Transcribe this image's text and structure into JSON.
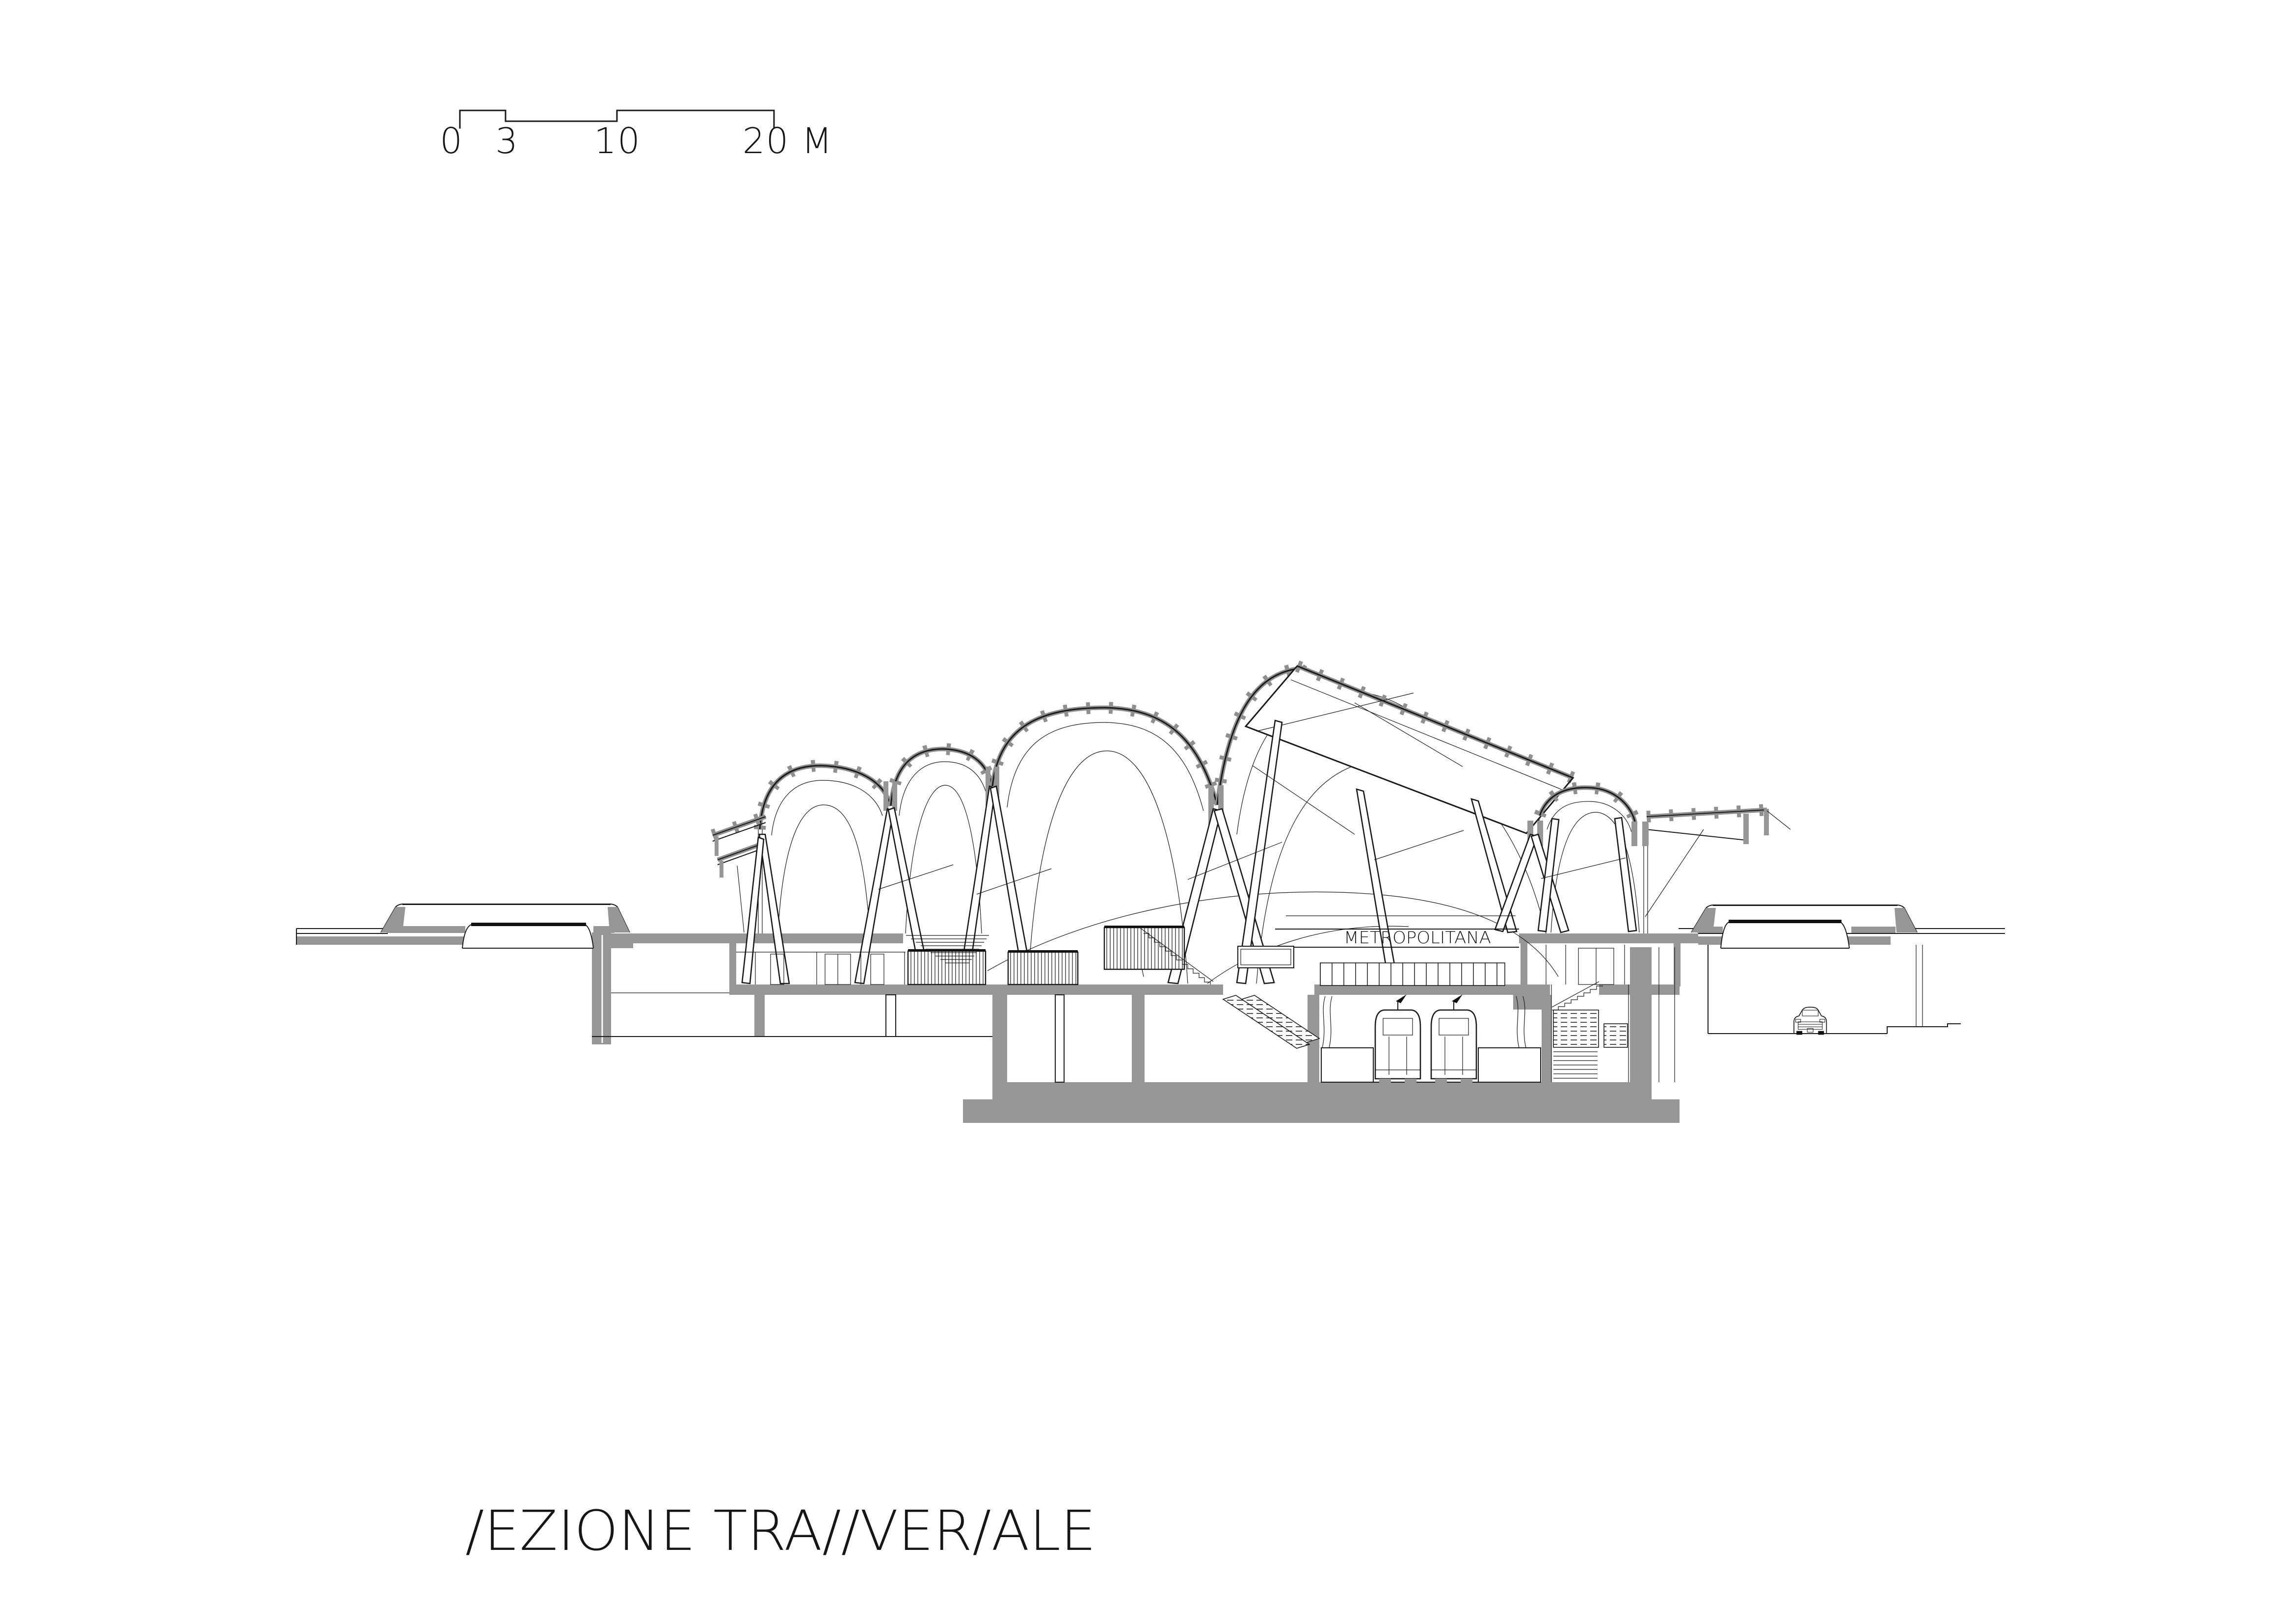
{
  "document": {
    "kind": "architectural section drawing",
    "background_color": "#ffffff",
    "ink_color": "#1a1a1a",
    "poche_color": "#969696",
    "rib_color": "#8f8f8f"
  },
  "scale_bar": {
    "labels": {
      "zero": "0",
      "three": "3",
      "ten": "10",
      "twenty": "20 M"
    }
  },
  "drawing": {
    "station_sign_text": "METROPOLITANA"
  },
  "caption": {
    "display_text": "/EZIONE TRA//VER/ALE",
    "reading": "SEZIONE TRASVERSALE"
  }
}
